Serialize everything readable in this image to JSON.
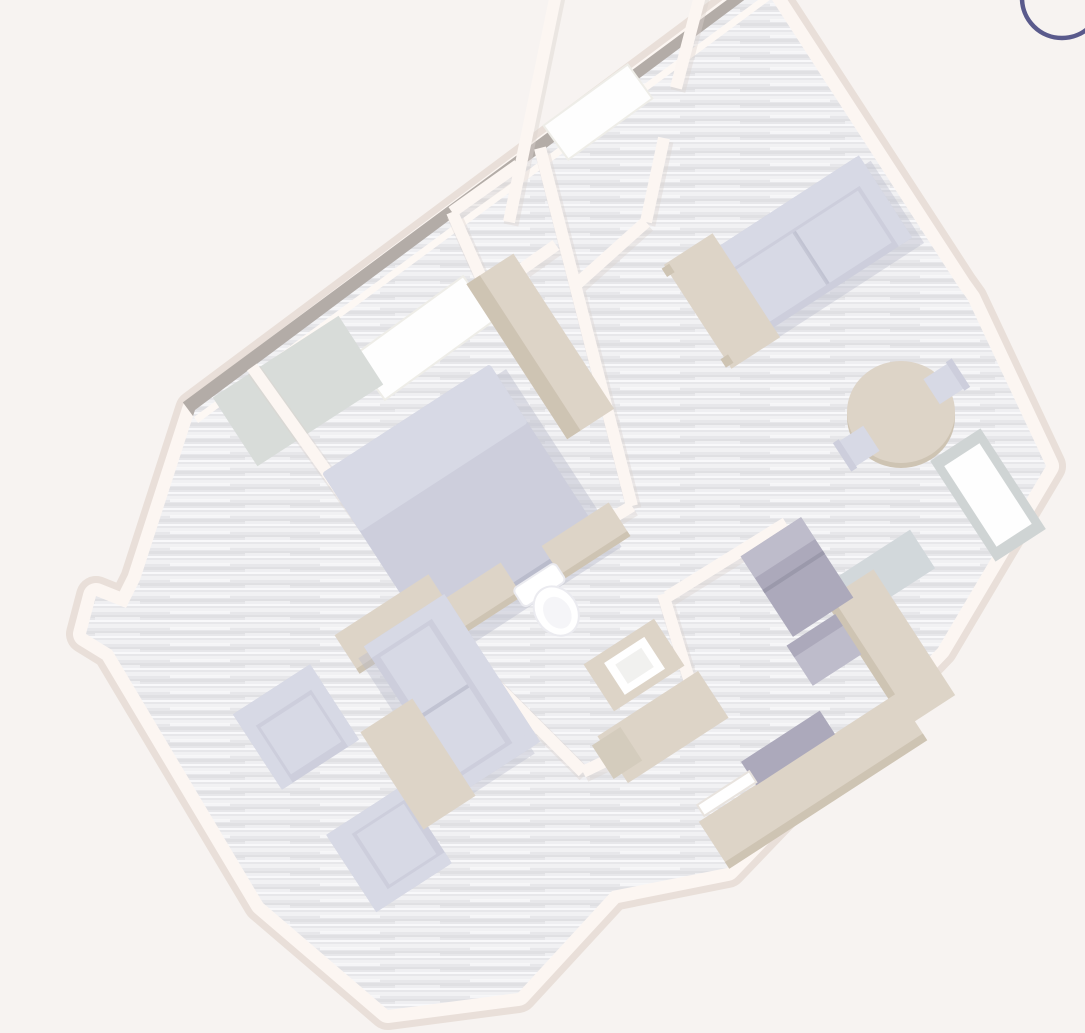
{
  "app": {
    "name": "3D floor plan viewer",
    "view_mode": "3d-top-down-rotated",
    "rotation_degrees": -33
  },
  "ui": {
    "rotate_ring": {
      "icon": "rotate-ring-icon",
      "position": "top-right",
      "color": "#5a5a8c"
    }
  },
  "palette": {
    "bg": "#f6f2ef",
    "floor_base": "#e4e4e8",
    "floor_light": "#efeff2",
    "floor_dark": "#d9d9de",
    "floor_streak": "#f8f8fa",
    "wall_white": "#fcf5f1",
    "wall_soft": "#e6dbd4",
    "wall_gray": "#a9a19b",
    "wall_cap": "#fdf7f3",
    "wall_shadow": "#d8cec8",
    "window_white": "#fefefe",
    "glass_gray": "#ccd3d7",
    "rug_gray": "#d3d8d4",
    "wall_face_gray": "#c9cfcf",
    "lavender_dark": "#b1b3c5",
    "lavender": "#c6c8d8",
    "lavender_light": "#d2d4e2",
    "lavender_lighter": "#dcdee9",
    "beige": "#d9cec0",
    "beige_dark": "#c8bca9",
    "beige_mid": "#cfc5b4",
    "appliance": "#a19eb2",
    "appliance_light": "#b6b3c4",
    "appliance_dark": "#8e8ba0",
    "white_fixture": "#ffffff",
    "fixture_stroke": "#e9e9ee",
    "arc_blue": "#5a5a8c"
  },
  "scene": {
    "rooms": [
      {
        "name": "bedroom",
        "furniture": [
          "double-bed",
          "wardrobe",
          "dresser",
          "dresser",
          "rug",
          "window"
        ]
      },
      {
        "name": "hallway",
        "furniture": [
          "window"
        ]
      },
      {
        "name": "closet",
        "furniture": []
      },
      {
        "name": "living-room",
        "furniture": [
          "sofa",
          "desk",
          "round-dining-table",
          "dining-chair",
          "dining-chair",
          "corner-window"
        ]
      },
      {
        "name": "bathroom",
        "furniture": [
          "toilet",
          "vanity-sink"
        ]
      },
      {
        "name": "kitchen",
        "furniture": [
          "refrigerator",
          "stove",
          "counter",
          "counter",
          "cooktop",
          "wall-shelf",
          "desk",
          "bench",
          "floor-mat"
        ]
      },
      {
        "name": "lounge",
        "furniture": [
          "sofa",
          "armchair",
          "armchair",
          "coffee-table",
          "console-table"
        ]
      }
    ]
  }
}
